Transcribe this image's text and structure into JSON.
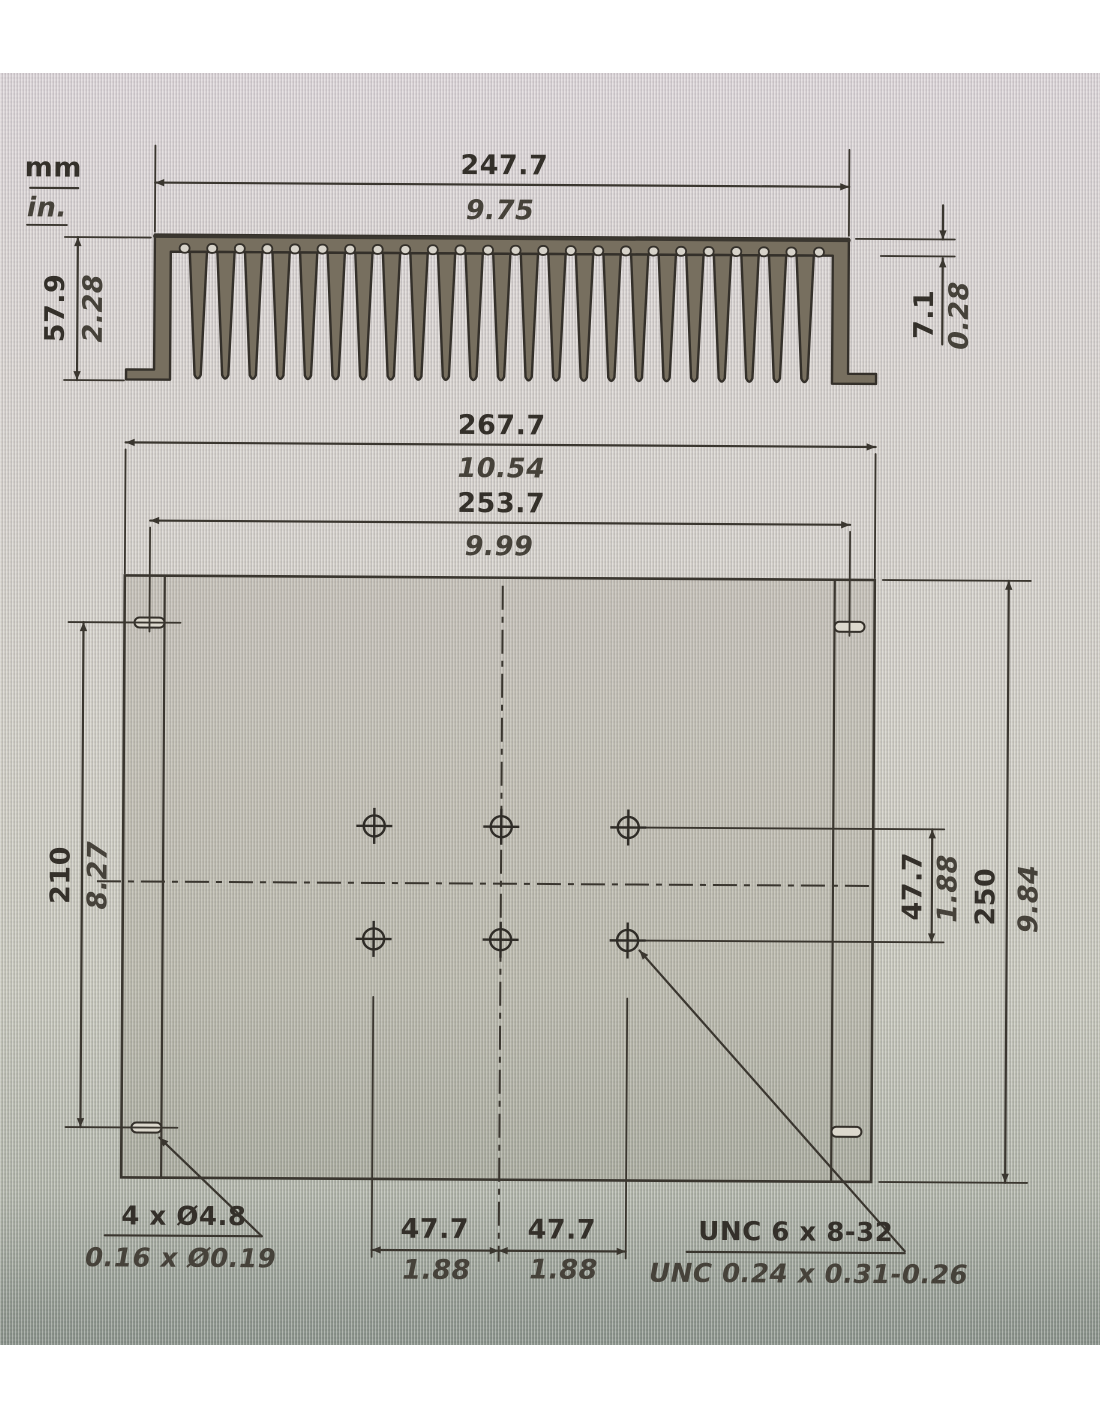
{
  "units": {
    "metric": "mm",
    "imperial": "in."
  },
  "section_view": {
    "fin_area_width": {
      "mm": "247.7",
      "in": "9.75"
    },
    "overall_height": {
      "mm": "57.9",
      "in": "2.28"
    },
    "base_thickness": {
      "mm": "7.1",
      "in": "0.28"
    }
  },
  "plan_view": {
    "overall_width": {
      "mm": "267.7",
      "in": "10.54"
    },
    "slot_span": {
      "mm": "253.7",
      "in": "9.99"
    },
    "slot_vertical_span": {
      "mm": "210",
      "in": "8.27"
    },
    "overall_depth": {
      "mm": "250",
      "in": "9.84"
    },
    "hole_row_spacing": {
      "mm": "47.7",
      "in": "1.88"
    },
    "hole_col_left": {
      "mm": "47.7",
      "in": "1.88"
    },
    "hole_col_right": {
      "mm": "47.7",
      "in": "1.88"
    }
  },
  "callouts": {
    "mounting_slots": {
      "mm": "4 x Ø4.8",
      "in": "0.16 x Ø0.19"
    },
    "tapped_holes": {
      "mm": "UNC 6 x 8-32",
      "in": "UNC 0.24 x 0.31-0.26"
    }
  },
  "colors": {
    "line": "#3a362f",
    "metal": "#776f5f",
    "ink": "#34302a"
  }
}
